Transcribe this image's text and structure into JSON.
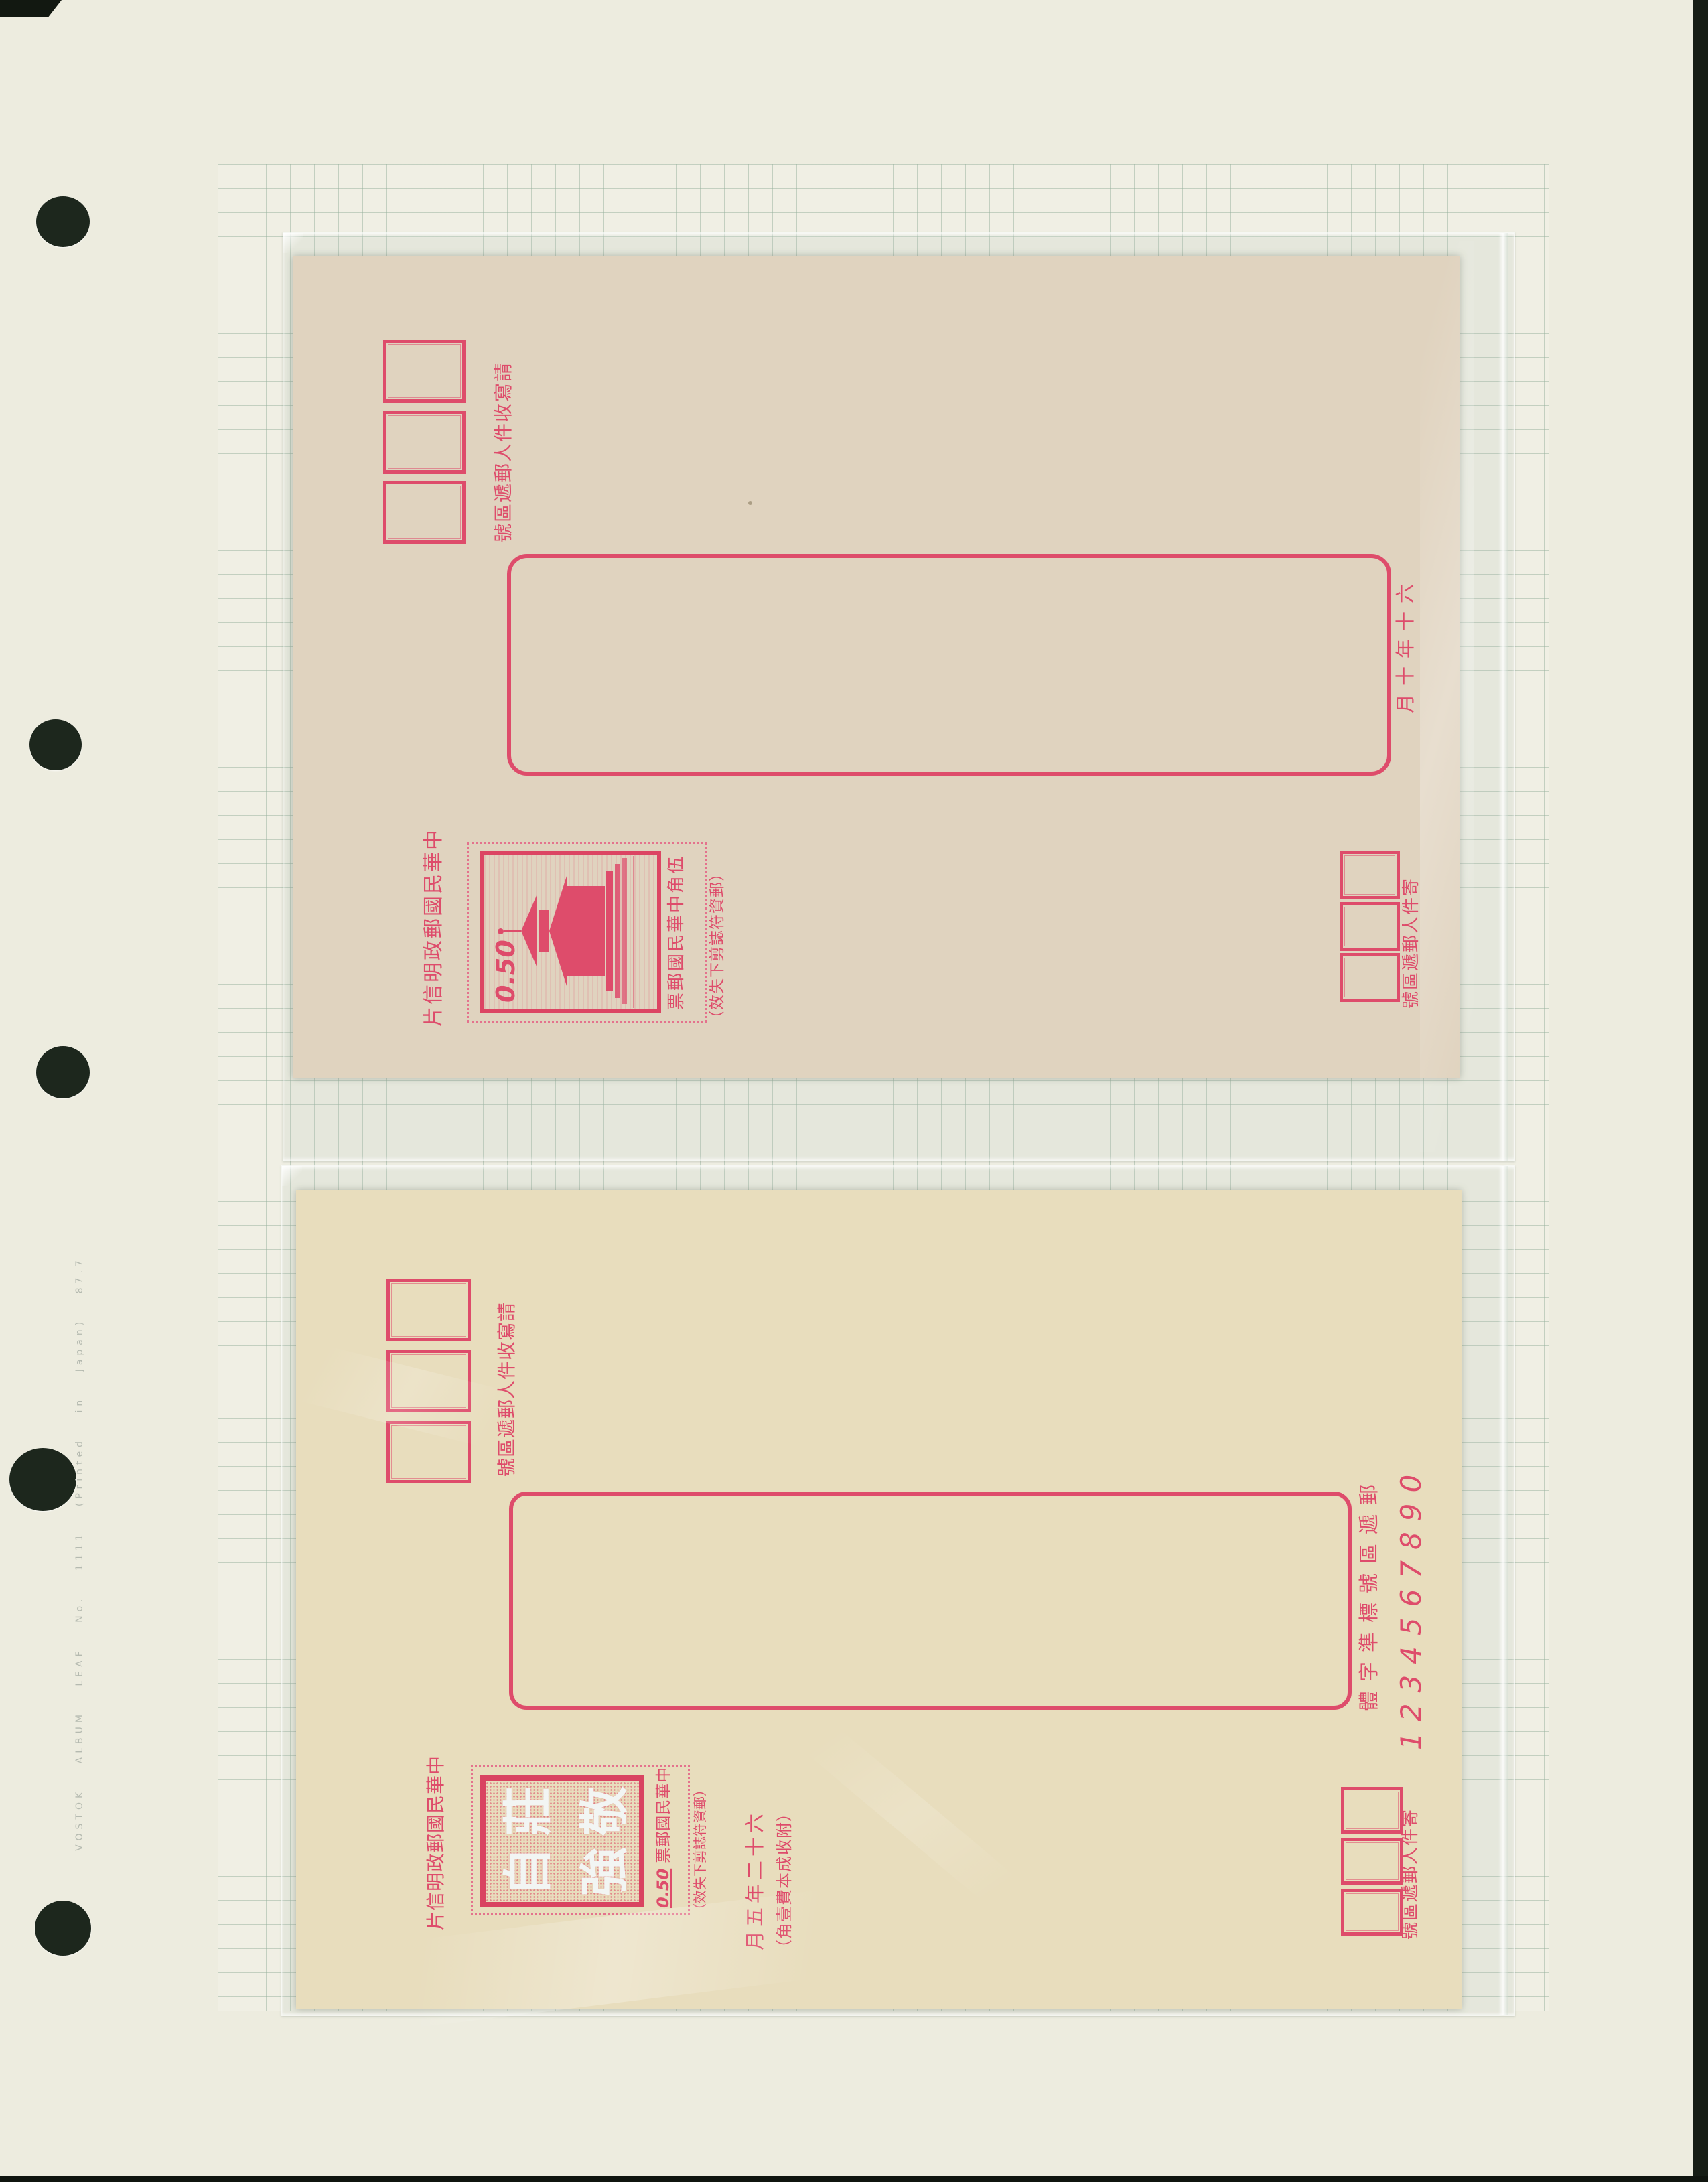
{
  "page": {
    "caption": "VOSTOK ALBUM LEAF No. 1111 (Printed in Japan) 87.7"
  },
  "colors": {
    "ink_red": "#e8365e",
    "card_top_bg": "#ead7c1",
    "card_bottom_bg": "#f4e3bf",
    "grid_line": "#96b09c",
    "page_bg": "#edecdf"
  },
  "top_card": {
    "title": "中華民國郵政明信片",
    "recipient_note": "請寫收件人郵遞區號",
    "sender_note": "寄件人郵遞區號",
    "cutout_note": "（郵資符誌剪下失效）",
    "date": "六十年十月",
    "stamp": {
      "value": "0.50",
      "inscription": "伍角中華民國郵票",
      "subject": "chungshan-building-pagoda"
    }
  },
  "bottom_card": {
    "title": "中華民國郵政明信片",
    "recipient_note": "請寫收件人郵遞區號",
    "sender_note": "寄件人郵遞區號",
    "cutout_note": "（郵資符誌剪下失效）",
    "date": "六十二年五月",
    "fee_note": "（附收成本費壹角）",
    "code_font_label": "郵遞區號標準字體",
    "code_font_digits": "1234567890",
    "stamp": {
      "value": "0.50",
      "inscription": "中華民國郵票",
      "chars": [
        "莊",
        "敬",
        "自",
        "強"
      ]
    }
  }
}
